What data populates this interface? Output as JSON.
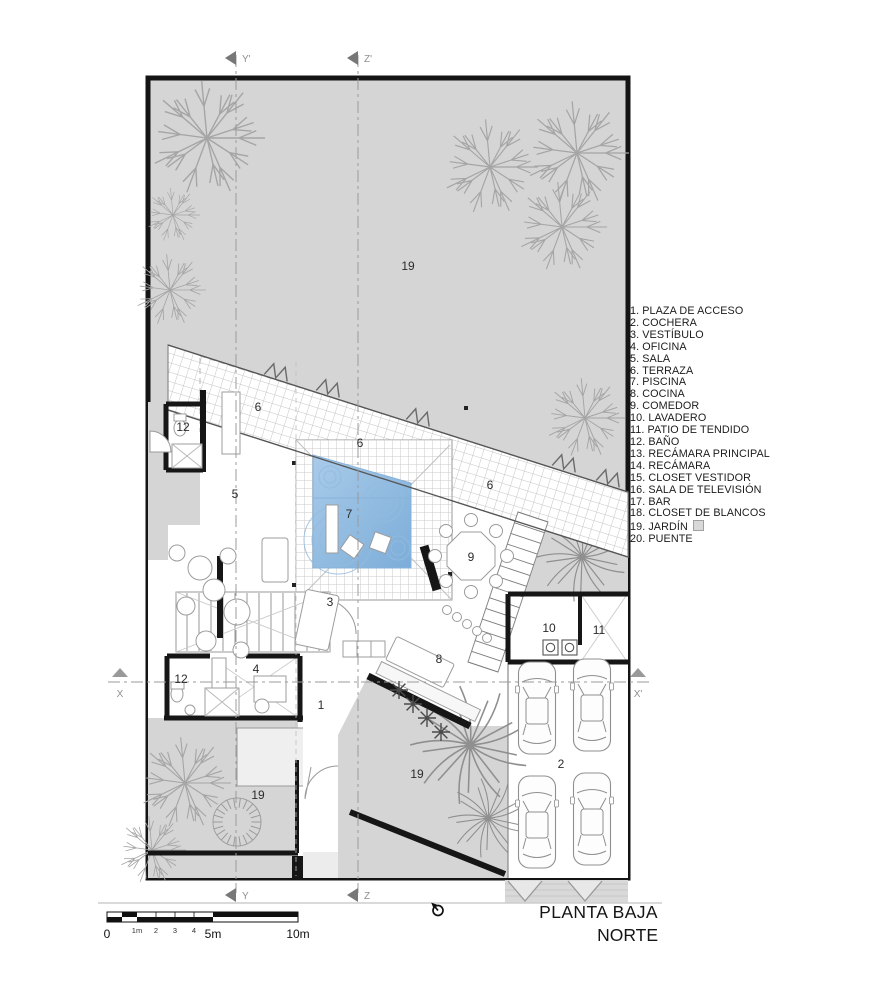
{
  "plan": {
    "title": "PLANTA BAJA",
    "north_label": "NORTE"
  },
  "legend": {
    "swatch_style": "background:#d9d9d9;border:1px solid #a0a0a0",
    "items": [
      {
        "num": "1.",
        "label": "PLAZA DE ACCESO"
      },
      {
        "num": "2.",
        "label": "COCHERA"
      },
      {
        "num": "3.",
        "label": "VESTÍBULO"
      },
      {
        "num": "4.",
        "label": "OFICINA"
      },
      {
        "num": "5.",
        "label": "SALA"
      },
      {
        "num": "6.",
        "label": "TERRAZA"
      },
      {
        "num": "7.",
        "label": "PISCINA"
      },
      {
        "num": "8.",
        "label": "COCINA"
      },
      {
        "num": "9.",
        "label": "COMEDOR"
      },
      {
        "num": "10.",
        "label": "LAVADERO"
      },
      {
        "num": "11.",
        "label": "PATIO DE TENDIDO"
      },
      {
        "num": "12.",
        "label": "BAÑO"
      },
      {
        "num": "13.",
        "label": "RECÁMARA PRINCIPAL"
      },
      {
        "num": "14.",
        "label": "RECÁMARA"
      },
      {
        "num": "15.",
        "label": "CLOSET VESTIDOR"
      },
      {
        "num": "16.",
        "label": "SALA DE TELEVISIÓN"
      },
      {
        "num": "17.",
        "label": "BAR"
      },
      {
        "num": "18.",
        "label": "CLOSET DE BLANCOS"
      },
      {
        "num": "19.",
        "label": "JARDÍN"
      },
      {
        "num": "20.",
        "label": "PUENTE"
      }
    ]
  },
  "scalebar": {
    "t0": "0",
    "t1": "1m",
    "t2": "2",
    "t3": "3",
    "t4": "4",
    "t5": "5m",
    "t10": "10m"
  },
  "markers": {
    "top_y": "Y'",
    "top_z": "Z'",
    "bottom_y": "Y",
    "bottom_z": "Z",
    "left_x": "X",
    "right_x": "X'"
  },
  "rooms": {
    "jardin_top": "19",
    "terraza_a": "6",
    "terraza_b": "6",
    "terraza_c": "6",
    "bano_top": "12",
    "sala": "5",
    "piscina": "7",
    "comedor": "9",
    "vestibulo": "3",
    "lavadero": "10",
    "patio_tendido": "11",
    "cocina": "8",
    "oficina": "4",
    "bano_low": "12",
    "plaza": "1",
    "cochera": "2",
    "jardin_left": "19",
    "jardin_mid": "19"
  },
  "colors": {
    "site_gray": "#d5d5d5",
    "pool_light": "#a9cbe9",
    "pool_dark": "#7cadd9",
    "wall": "#161616",
    "swatch": "#d9d9d9"
  }
}
